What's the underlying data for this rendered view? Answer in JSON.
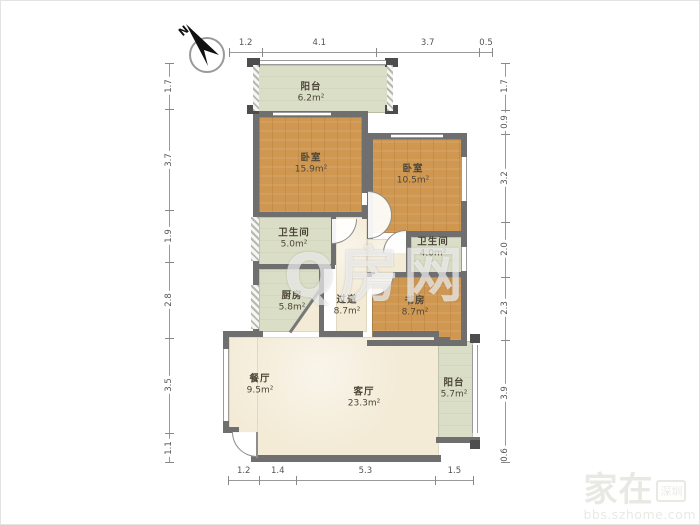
{
  "compass": {
    "label": "N"
  },
  "dimensions": {
    "top": [
      "1.2",
      "4.1",
      "3.7",
      "0.5"
    ],
    "bottom": [
      "1.2",
      "1.4",
      "5.3",
      "1.5"
    ],
    "left": [
      "1.7",
      "3.7",
      "1.9",
      "2.8",
      "3.5",
      "1.1"
    ],
    "right": [
      "1.7",
      "0.9",
      "3.2",
      "2.0",
      "2.3",
      "3.9",
      "0.6"
    ]
  },
  "rooms": [
    {
      "name": "阳台",
      "area": "6.2m²"
    },
    {
      "name": "卧室",
      "area": "15.9m²"
    },
    {
      "name": "卧室",
      "area": "10.5m²"
    },
    {
      "name": "卫生间",
      "area": "5.0m²"
    },
    {
      "name": "卫生间",
      "area": "4.0m²"
    },
    {
      "name": "厨房",
      "area": "5.8m²"
    },
    {
      "name": "过道",
      "area": "8.7m²"
    },
    {
      "name": "书房",
      "area": "8.7m²"
    },
    {
      "name": "餐厅",
      "area": "9.5m²"
    },
    {
      "name": "客厅",
      "area": "23.3m²"
    },
    {
      "name": "阳台",
      "area": "5.7m²"
    }
  ],
  "watermarks": {
    "center": "Q房网",
    "corner_main": "家在",
    "corner_badge": "深圳",
    "corner_site": "bbs.szhome.com"
  },
  "colors": {
    "wall": "#6f6f6f",
    "wood_floor": "#cf9750",
    "tile_floor": "#dbdec6",
    "plaster_floor": "#f3ebd6"
  }
}
